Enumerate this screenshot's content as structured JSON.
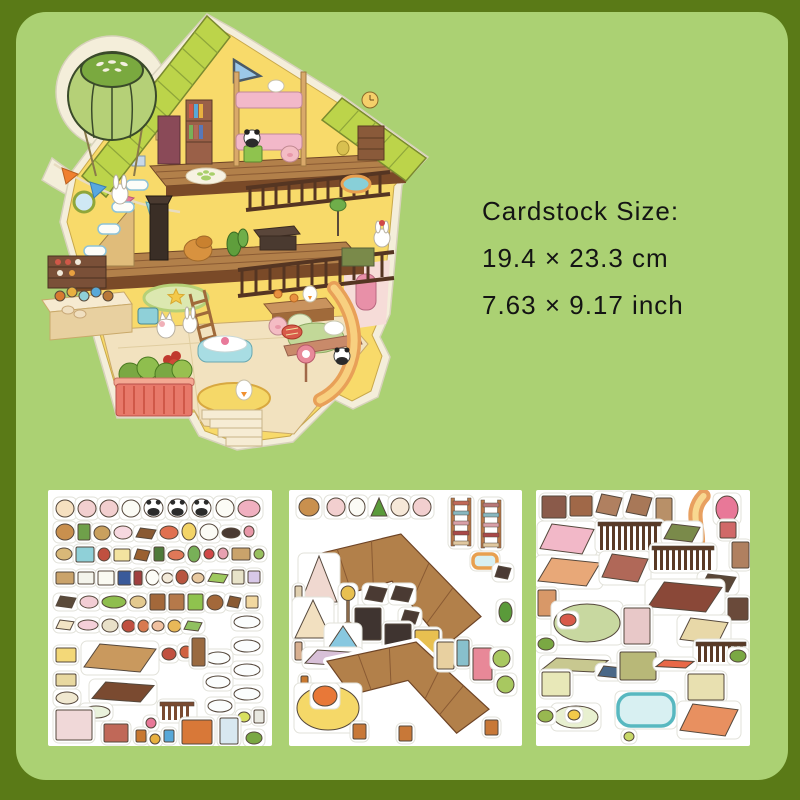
{
  "page": {
    "background": "#5a7a17",
    "panel_color": "#abd173",
    "panel_radius": 30
  },
  "size_info": {
    "line1": "Cardstock Size:",
    "line2": "19.4 × 23.3 cm",
    "line3": "7.63 × 9.17 inch",
    "text_color": "#141414"
  },
  "house": {
    "name": "isometric-dollhouse-sticker",
    "palette": {
      "sticker_edge": "#f4eeda",
      "roof": "#bcd44a",
      "wall": "#f8da6a",
      "floor": "#b2804a",
      "floor_edge": "#7a4a28",
      "railing": "#553522",
      "balloon": "#b5d077",
      "balloon_cap": "#7aa93f"
    }
  },
  "sheets": [
    {
      "name": "sticker-sheet-decor",
      "x": 48,
      "y": 490,
      "w": 224,
      "h": 256,
      "items": [
        [
          "e",
          8,
          10,
          18,
          17,
          "#f6e0c0"
        ],
        [
          "e",
          30,
          10,
          18,
          17,
          "#f2cfcf"
        ],
        [
          "e",
          52,
          10,
          18,
          17,
          "#f2cfcf"
        ],
        [
          "e",
          74,
          10,
          18,
          17,
          "#fbfbf5"
        ],
        [
          "panda",
          96,
          9,
          19,
          18,
          "#ffffff"
        ],
        [
          "panda",
          120,
          9,
          19,
          18,
          "#ffffff"
        ],
        [
          "panda",
          144,
          9,
          19,
          18,
          "#ffffff"
        ],
        [
          "e",
          168,
          9,
          18,
          18,
          "#fcfcf6"
        ],
        [
          "e",
          190,
          10,
          22,
          17,
          "#f0b0c0"
        ],
        [
          "e",
          8,
          34,
          18,
          16,
          "#c9904e"
        ],
        [
          "r",
          30,
          34,
          12,
          16,
          "#6fa04a"
        ],
        [
          "e",
          46,
          36,
          16,
          14,
          "#c9a05e"
        ],
        [
          "e",
          66,
          36,
          18,
          13,
          "#f6d8e0"
        ],
        [
          "p",
          88,
          38,
          20,
          11,
          "#8a5a33"
        ],
        [
          "e",
          112,
          36,
          18,
          13,
          "#e07050"
        ],
        [
          "e",
          134,
          33,
          14,
          17,
          "#f3d468"
        ],
        [
          "e",
          152,
          34,
          18,
          16,
          "#fbfbf5"
        ],
        [
          "e",
          174,
          38,
          18,
          10,
          "#4a3a33"
        ],
        [
          "e",
          196,
          36,
          10,
          11,
          "#e898a8"
        ],
        [
          "e",
          8,
          58,
          16,
          12,
          "#d8b878"
        ],
        [
          "r",
          28,
          57,
          18,
          15,
          "#8fd0d8"
        ],
        [
          "e",
          50,
          58,
          12,
          13,
          "#c05040"
        ],
        [
          "r",
          66,
          59,
          16,
          12,
          "#f3e3a0"
        ],
        [
          "p",
          86,
          59,
          16,
          12,
          "#9a6030"
        ],
        [
          "r",
          106,
          57,
          10,
          14,
          "#4f7a3a"
        ],
        [
          "e",
          120,
          60,
          16,
          10,
          "#e07858"
        ],
        [
          "e",
          140,
          56,
          12,
          16,
          "#78b058"
        ],
        [
          "e",
          156,
          59,
          10,
          10,
          "#d04848"
        ],
        [
          "e",
          170,
          58,
          10,
          11,
          "#e8a0b0"
        ],
        [
          "r",
          184,
          58,
          18,
          12,
          "#caa36b"
        ],
        [
          "e",
          206,
          59,
          10,
          10,
          "#98c060"
        ],
        [
          "r",
          8,
          82,
          18,
          12,
          "#caa36b"
        ],
        [
          "r",
          30,
          82,
          16,
          12,
          "#f4f4ec"
        ],
        [
          "r",
          50,
          81,
          16,
          14,
          "#fafaf2"
        ],
        [
          "r",
          70,
          81,
          13,
          14,
          "#3a5a9a"
        ],
        [
          "r",
          86,
          81,
          8,
          14,
          "#a04040"
        ],
        [
          "e",
          98,
          80,
          13,
          15,
          "#fdfdf8"
        ],
        [
          "e",
          114,
          83,
          11,
          10,
          "#f2e9d8"
        ],
        [
          "e",
          128,
          80,
          12,
          14,
          "#b8553f"
        ],
        [
          "e",
          144,
          83,
          12,
          10,
          "#e8c9a0"
        ],
        [
          "p",
          160,
          83,
          20,
          10,
          "#9ec95e"
        ],
        [
          "r",
          184,
          80,
          12,
          14,
          "#e8e3c9"
        ],
        [
          "r",
          200,
          81,
          12,
          12,
          "#d8c8e8"
        ],
        [
          "p",
          8,
          106,
          20,
          12,
          "#5a4a3a"
        ],
        [
          "e",
          32,
          106,
          18,
          12,
          "#f2cdd4"
        ],
        [
          "e",
          54,
          106,
          24,
          12,
          "#8fbe4e"
        ],
        [
          "e",
          82,
          106,
          16,
          12,
          "#e3c98f"
        ],
        [
          "r",
          102,
          104,
          15,
          16,
          "#a3683a"
        ],
        [
          "r",
          121,
          104,
          15,
          16,
          "#b5794a"
        ],
        [
          "r",
          140,
          104,
          15,
          16,
          "#8fc34e"
        ],
        [
          "e",
          159,
          105,
          16,
          15,
          "#a3683a"
        ],
        [
          "p",
          179,
          106,
          14,
          12,
          "#8a5a33"
        ],
        [
          "r",
          198,
          106,
          12,
          12,
          "#f2d8a0"
        ],
        [
          "p",
          8,
          130,
          18,
          10,
          "#f2e3c4"
        ],
        [
          "e",
          30,
          130,
          20,
          10,
          "#f4cfd8"
        ],
        [
          "e",
          54,
          129,
          16,
          13,
          "#e8e0c8"
        ],
        [
          "e",
          74,
          130,
          13,
          12,
          "#c05040"
        ],
        [
          "e",
          90,
          130,
          11,
          12,
          "#d87a50"
        ],
        [
          "e",
          104,
          131,
          12,
          10,
          "#f0c0a0"
        ],
        [
          "e",
          120,
          130,
          13,
          12,
          "#e8b858"
        ],
        [
          "p",
          136,
          131,
          18,
          10,
          "#90c060"
        ],
        [
          "e",
          186,
          126,
          26,
          12,
          "#fbfdfd"
        ],
        [
          "e",
          186,
          150,
          26,
          12,
          "#fbfdfd"
        ],
        [
          "e",
          186,
          174,
          26,
          12,
          "#fbfdfd"
        ],
        [
          "e",
          186,
          198,
          26,
          12,
          "#fbfdfd"
        ],
        [
          "e",
          158,
          162,
          24,
          12,
          "#fbfdfd"
        ],
        [
          "e",
          158,
          186,
          24,
          12,
          "#fbfdfd"
        ],
        [
          "e",
          160,
          210,
          24,
          12,
          "#fbfdfd"
        ],
        [
          "p",
          36,
          154,
          72,
          28,
          "#c9995e"
        ],
        [
          "r",
          8,
          158,
          20,
          14,
          "#f3d878"
        ],
        [
          "e",
          114,
          158,
          14,
          12,
          "#c05040"
        ],
        [
          "e",
          132,
          156,
          12,
          12,
          "#d06040"
        ],
        [
          "r",
          144,
          148,
          13,
          28,
          "#9a6a40"
        ],
        [
          "r",
          8,
          184,
          20,
          12,
          "#e8d8a0"
        ],
        [
          "p",
          44,
          192,
          62,
          20,
          "#7a4a30"
        ],
        [
          "e",
          8,
          202,
          22,
          12,
          "#f0e8d0"
        ],
        [
          "e",
          34,
          216,
          28,
          12,
          "#eaf2dc"
        ],
        [
          "fence",
          112,
          212,
          34,
          18,
          "#7a4a30"
        ],
        [
          "e",
          190,
          222,
          12,
          10,
          "#d8e060"
        ],
        [
          "r",
          206,
          220,
          10,
          13,
          "#e8e8e0"
        ],
        [
          "r",
          8,
          220,
          36,
          30,
          "#f0d8d8"
        ],
        [
          "r",
          56,
          234,
          24,
          18,
          "#c06858"
        ],
        [
          "e",
          98,
          228,
          10,
          10,
          "#e87898"
        ],
        [
          "r",
          88,
          240,
          10,
          12,
          "#c87830"
        ],
        [
          "e",
          102,
          244,
          10,
          10,
          "#e8b040"
        ],
        [
          "r",
          116,
          240,
          10,
          12,
          "#58a8d8"
        ],
        [
          "r",
          134,
          230,
          30,
          24,
          "#d87838"
        ],
        [
          "r",
          172,
          228,
          18,
          26,
          "#d8e8f0"
        ],
        [
          "e",
          198,
          242,
          16,
          12,
          "#7aa843"
        ]
      ]
    },
    {
      "name": "sticker-sheet-floors",
      "x": 289,
      "y": 490,
      "w": 233,
      "h": 256,
      "items": [
        [
          "e",
          10,
          8,
          20,
          18,
          "#c9904e"
        ],
        [
          "e",
          38,
          8,
          18,
          18,
          "#f2cfcf"
        ],
        [
          "e",
          60,
          8,
          16,
          18,
          "#fbfbf5"
        ],
        [
          "tri",
          82,
          8,
          16,
          18,
          "#5a9a3a"
        ],
        [
          "e",
          102,
          8,
          18,
          18,
          "#f6e8d8"
        ],
        [
          "e",
          124,
          8,
          18,
          18,
          "#f2cfcf"
        ],
        [
          "ladder",
          162,
          8,
          20,
          48,
          "#c06858"
        ],
        [
          "ladder",
          192,
          10,
          20,
          48,
          "#b87878"
        ],
        [
          "floor",
          14,
          44,
          178,
          118,
          "#b2804a"
        ],
        [
          "pool",
          184,
          64,
          24,
          14,
          "#e8a050"
        ],
        [
          "p",
          206,
          76,
          16,
          13,
          "#4a3a33"
        ],
        [
          "tri",
          12,
          66,
          36,
          46,
          "#f0d8d0"
        ],
        [
          "r",
          6,
          96,
          7,
          20,
          "#e0d0b0"
        ],
        [
          "tri",
          6,
          110,
          36,
          38,
          "#f2e0c0"
        ],
        [
          "lamp",
          52,
          96,
          14,
          40,
          "#e8c050"
        ],
        [
          "p",
          76,
          96,
          22,
          16,
          "#4a3a33"
        ],
        [
          "p",
          102,
          96,
          22,
          16,
          "#4a3a33"
        ],
        [
          "p",
          112,
          120,
          18,
          14,
          "#4a3a33"
        ],
        [
          "r",
          66,
          118,
          26,
          32,
          "#3f3430"
        ],
        [
          "r",
          96,
          134,
          26,
          32,
          "#3f3430"
        ],
        [
          "r",
          126,
          140,
          24,
          34,
          "#e8c050"
        ],
        [
          "tri",
          38,
          136,
          32,
          24,
          "#88c8e0"
        ],
        [
          "r",
          6,
          152,
          7,
          18,
          "#d8b090"
        ],
        [
          "p",
          16,
          160,
          56,
          16,
          "#d8c0d8"
        ],
        [
          "r",
          12,
          186,
          7,
          16,
          "#c87830"
        ],
        [
          "floor",
          38,
          152,
          162,
          96,
          "#b2804a"
        ],
        [
          "r",
          148,
          152,
          17,
          27,
          "#e8d0a0"
        ],
        [
          "r",
          168,
          150,
          12,
          26,
          "#88c0cc"
        ],
        [
          "r",
          184,
          158,
          19,
          32,
          "#e88898"
        ],
        [
          "e",
          204,
          160,
          17,
          17,
          "#a8c860"
        ],
        [
          "e",
          208,
          186,
          17,
          17,
          "#a8c860"
        ],
        [
          "e",
          210,
          112,
          13,
          20,
          "#5a9a3a"
        ],
        [
          "e",
          8,
          196,
          62,
          44,
          "#f5d868"
        ],
        [
          "e",
          24,
          196,
          24,
          20,
          "#e87838"
        ],
        [
          "r",
          64,
          234,
          13,
          15,
          "#c87838"
        ],
        [
          "r",
          110,
          236,
          13,
          15,
          "#c87838"
        ],
        [
          "r",
          196,
          230,
          13,
          15,
          "#c87838"
        ]
      ]
    },
    {
      "name": "sticker-sheet-furniture",
      "x": 536,
      "y": 490,
      "w": 214,
      "h": 256,
      "items": [
        [
          "r",
          6,
          6,
          24,
          22,
          "#8a5a4a"
        ],
        [
          "r",
          34,
          6,
          22,
          20,
          "#a06848"
        ],
        [
          "p",
          60,
          4,
          26,
          22,
          "#b08060"
        ],
        [
          "p",
          90,
          4,
          26,
          22,
          "#a87858"
        ],
        [
          "r",
          120,
          8,
          16,
          24,
          "#b89068"
        ],
        [
          "slide",
          142,
          4,
          34,
          72,
          "#e8a060"
        ],
        [
          "e",
          180,
          6,
          22,
          26,
          "#e87898"
        ],
        [
          "r",
          184,
          32,
          16,
          16,
          "#d06868"
        ],
        [
          "r",
          196,
          52,
          17,
          26,
          "#b08060"
        ],
        [
          "p",
          4,
          34,
          54,
          30,
          "#f2b8c8"
        ],
        [
          "fence",
          62,
          32,
          64,
          28,
          "#5a3a26"
        ],
        [
          "p",
          128,
          34,
          36,
          18,
          "#7a8a4a"
        ],
        [
          "p",
          2,
          68,
          62,
          28,
          "#e8a878"
        ],
        [
          "p",
          66,
          64,
          46,
          28,
          "#b06858"
        ],
        [
          "fence",
          116,
          56,
          62,
          24,
          "#5a3a26"
        ],
        [
          "p",
          164,
          84,
          36,
          18,
          "#5a4636"
        ],
        [
          "r",
          2,
          100,
          18,
          26,
          "#d89868"
        ],
        [
          "p",
          112,
          92,
          74,
          30,
          "#8a4838"
        ],
        [
          "r",
          192,
          108,
          20,
          22,
          "#6a4a3a"
        ],
        [
          "e",
          18,
          114,
          66,
          38,
          "#c8d8a0"
        ],
        [
          "e",
          24,
          124,
          16,
          12,
          "#d85a4a"
        ],
        [
          "r",
          88,
          118,
          26,
          36,
          "#e8c8c8"
        ],
        [
          "p",
          144,
          128,
          48,
          26,
          "#e8d8a8"
        ],
        [
          "fence",
          160,
          152,
          50,
          20,
          "#5a3a26"
        ],
        [
          "e",
          2,
          148,
          16,
          12,
          "#7aa843"
        ],
        [
          "e",
          194,
          160,
          16,
          12,
          "#7aa843"
        ],
        [
          "p",
          6,
          168,
          66,
          14,
          "#c8c890"
        ],
        [
          "r",
          6,
          182,
          28,
          24,
          "#e8e8b8"
        ],
        [
          "p",
          62,
          176,
          26,
          12,
          "#4a6888"
        ],
        [
          "r",
          84,
          162,
          36,
          28,
          "#b8b878"
        ],
        [
          "p",
          120,
          170,
          38,
          8,
          "#e86848"
        ],
        [
          "r",
          152,
          184,
          36,
          26,
          "#e8e0b0"
        ],
        [
          "pool",
          82,
          204,
          56,
          32,
          "#58b8c0"
        ],
        [
          "e",
          18,
          216,
          44,
          22,
          "#e8f0d0"
        ],
        [
          "e",
          32,
          220,
          12,
          10,
          "#f3c94a"
        ],
        [
          "p",
          144,
          214,
          58,
          32,
          "#e89060"
        ],
        [
          "e",
          2,
          220,
          15,
          12,
          "#98b850"
        ],
        [
          "e",
          88,
          242,
          10,
          9,
          "#c8d868"
        ]
      ]
    }
  ]
}
